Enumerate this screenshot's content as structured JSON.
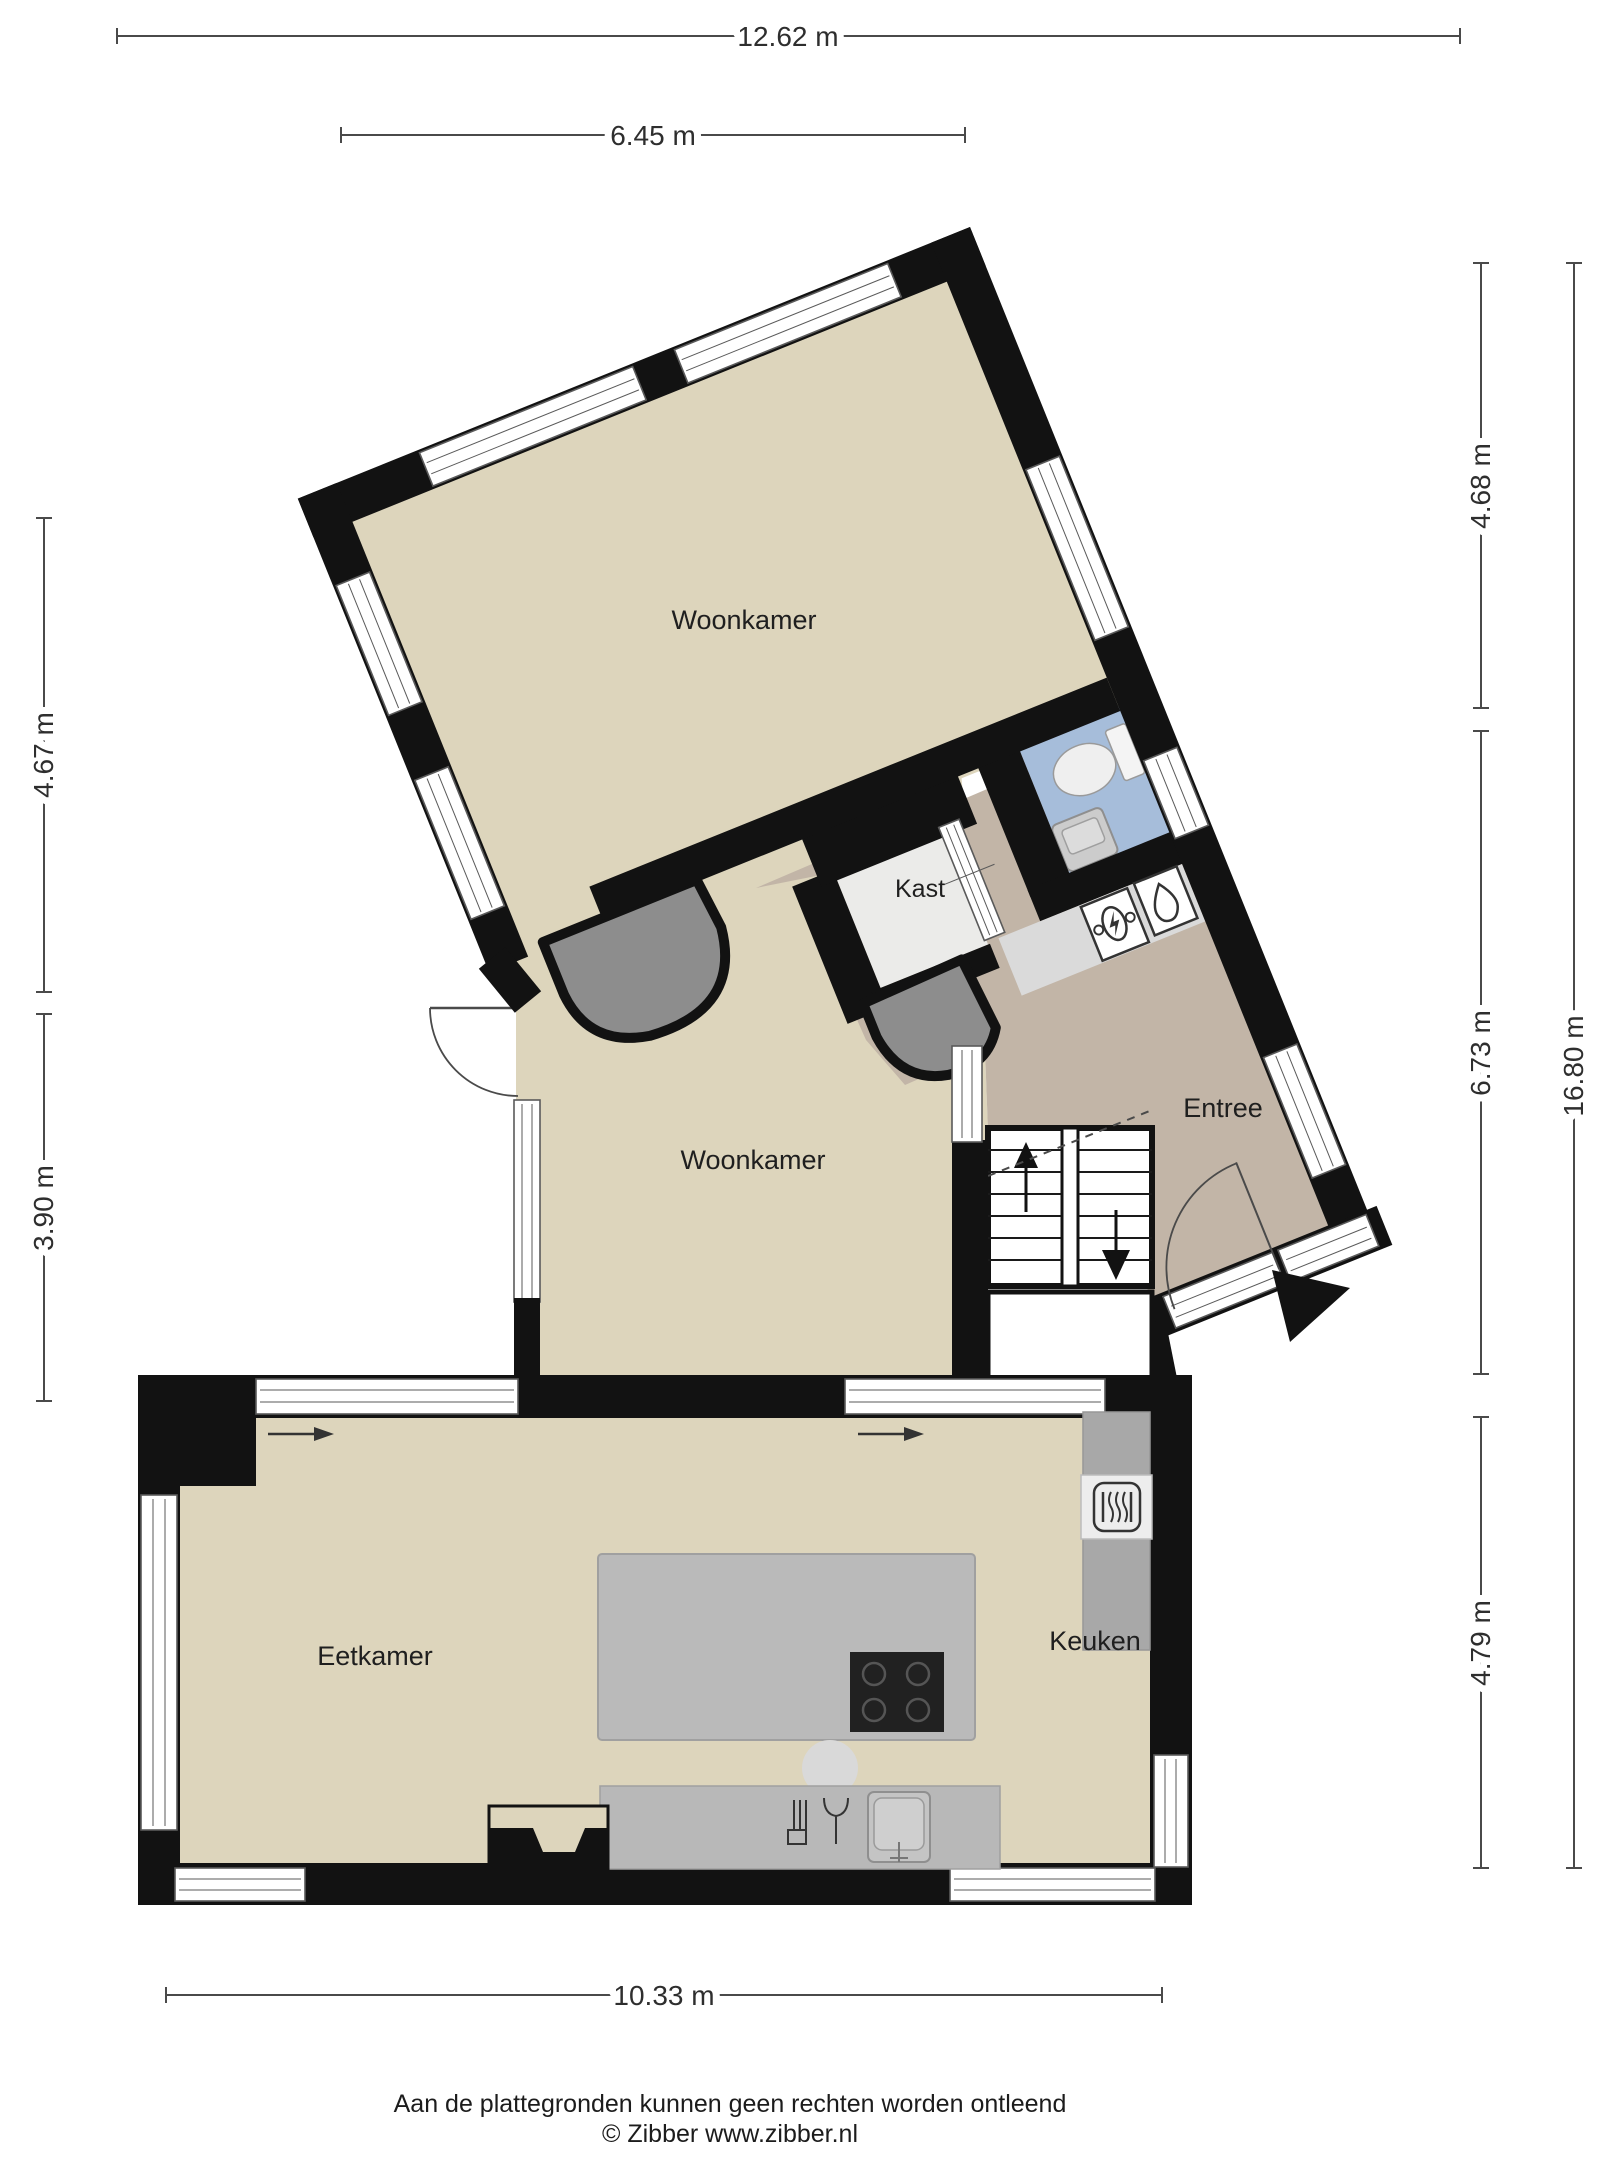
{
  "title": "Begane grond plattegrond",
  "rooms": {
    "woonkamer_boven": "Woonkamer",
    "woonkamer_midden": "Woonkamer",
    "kast": "Kast",
    "entree": "Entree",
    "eetkamer": "Eetkamer",
    "keuken": "Keuken"
  },
  "dimensions": {
    "top_full": "12.62 m",
    "top_partial": "6.45 m",
    "left_upper": "4.67 m",
    "left_lower": "3.90 m",
    "right_upper": "4.68 m",
    "right_middle": "6.73 m",
    "right_lower": "4.79 m",
    "right_total": "16.80 m",
    "bottom": "10.33 m"
  },
  "footer": {
    "disclaimer": "Aan de plattegronden kunnen geen rechten worden ontleend",
    "copyright": "© Zibber www.zibber.nl"
  },
  "colors": {
    "wall": "#121212",
    "floor_main": "#ddd5bc",
    "floor_hall": "#c2b5a7",
    "floor_wc": "#a6bdda",
    "floor_kast": "#ebebe9",
    "divider": "#8d8d8d",
    "counter": "#b8b8b8",
    "counter_tall": "#a8a8a8",
    "cooktop": "#212121"
  },
  "icons": {
    "toilet": "toilet-icon",
    "wc_sink": "sink-icon",
    "electric_meter": "electric-meter-icon",
    "water_heater": "water-drop-icon",
    "oven": "oven-icon",
    "cooktop": "cooktop-icon",
    "kitchen_sink": "kitchen-sink-icon",
    "dishwasher": "dishwasher-icon",
    "stairs_up": "stairs-up-arrow",
    "stairs_down": "stairs-down-arrow",
    "entrance": "entrance-arrow"
  }
}
